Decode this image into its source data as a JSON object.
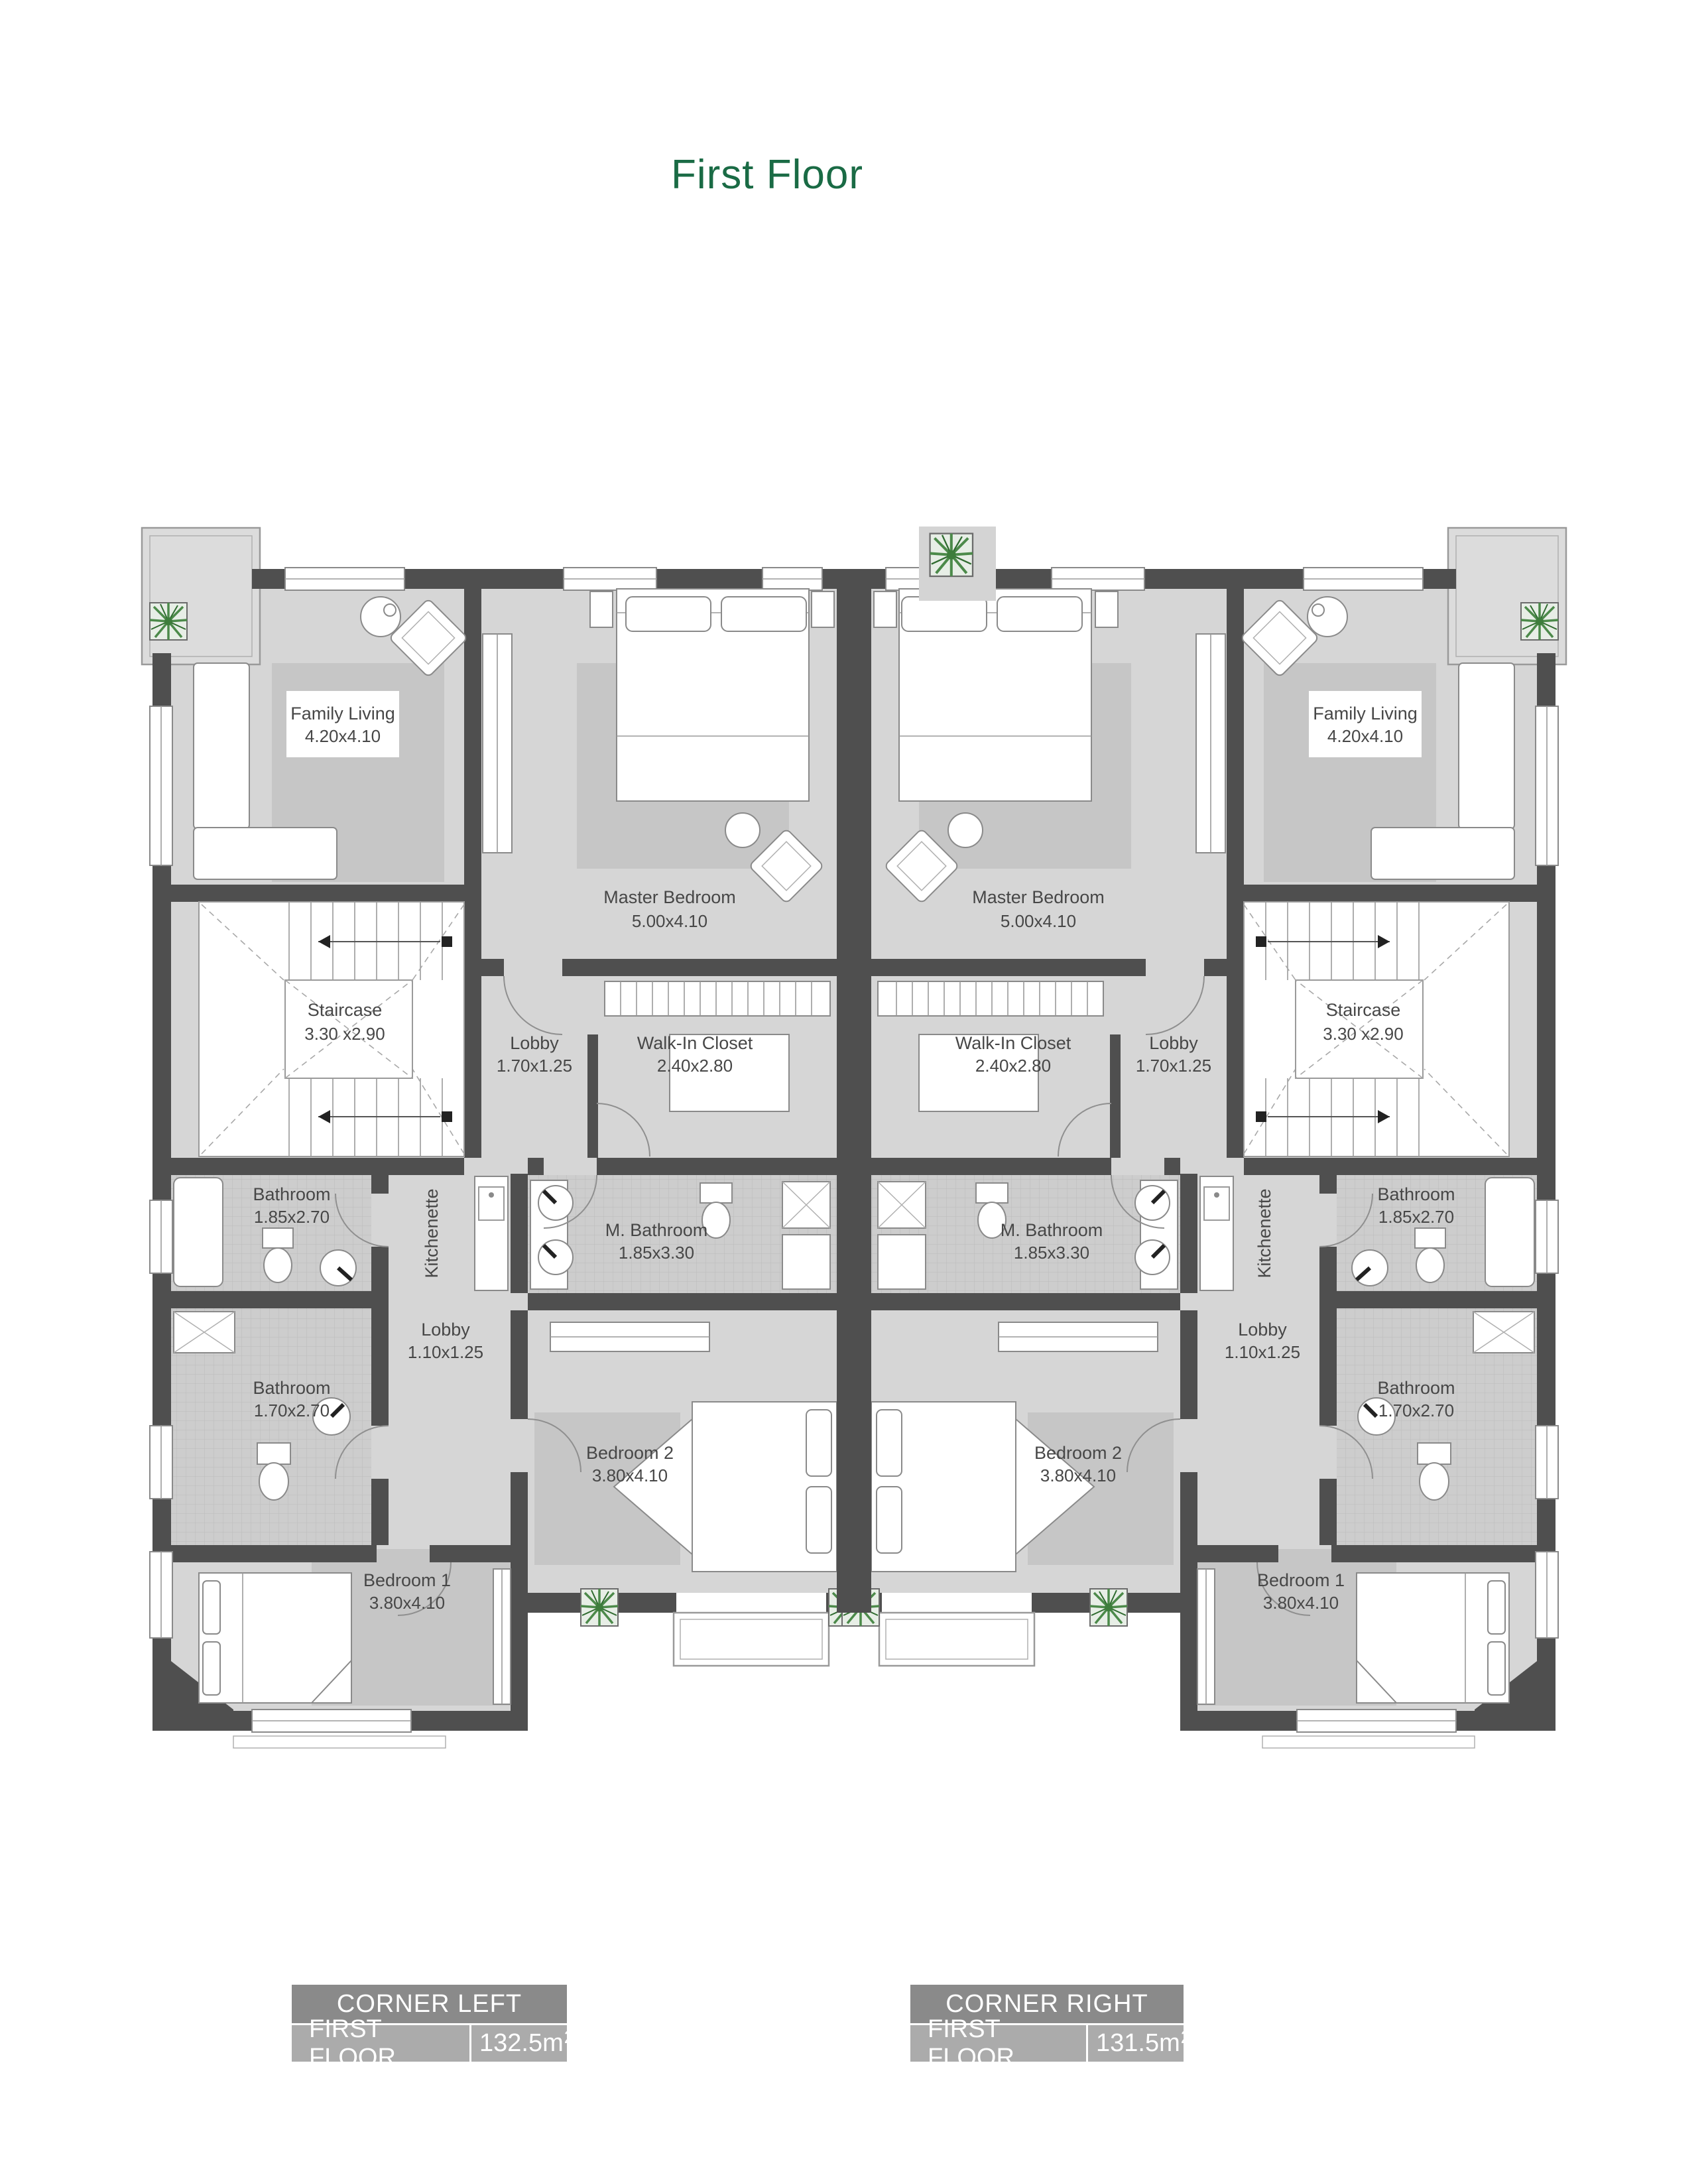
{
  "page": {
    "title": "First Floor"
  },
  "plan": {
    "rooms": {
      "family_living": {
        "name": "Family Living",
        "dims": "4.20x4.10"
      },
      "master_bedroom": {
        "name": "Master Bedroom",
        "dims": "5.00x4.10"
      },
      "staircase": {
        "name": "Staircase",
        "dims": "3.30 x2.90"
      },
      "lobby_upper": {
        "name": "Lobby",
        "dims": "1.70x1.25"
      },
      "walk_in_closet": {
        "name": "Walk-In Closet",
        "dims": "2.40x2.80"
      },
      "bathroom_upper": {
        "name": "Bathroom",
        "dims": "1.85x2.70"
      },
      "m_bathroom": {
        "name": "M. Bathroom",
        "dims": "1.85x3.30"
      },
      "kitchenette": {
        "name": "Kitchenette"
      },
      "lobby_lower": {
        "name": "Lobby",
        "dims": "1.10x1.25"
      },
      "bathroom_lower": {
        "name": "Bathroom",
        "dims": "1.70x2.70"
      },
      "bedroom_1": {
        "name": "Bedroom 1",
        "dims": "3.80x4.10"
      },
      "bedroom_2": {
        "name": "Bedroom 2",
        "dims": "3.80x4.10"
      }
    }
  },
  "legend": {
    "left": {
      "title": "CORNER LEFT",
      "floor_label": "FIRST FLOOR",
      "area": "132.5m",
      "area_sup": "2"
    },
    "right": {
      "title": "CORNER RIGHT",
      "floor_label": "FIRST FLOOR",
      "area": "131.5m",
      "area_sup": "2"
    }
  },
  "colors": {
    "title_green": "#1a6b45",
    "wall": "#4f4f4f",
    "floor": "#d6d6d6",
    "legend_header": "#8a8a8a",
    "legend_row": "#ababab",
    "plant_green": "#4c8a4a"
  }
}
